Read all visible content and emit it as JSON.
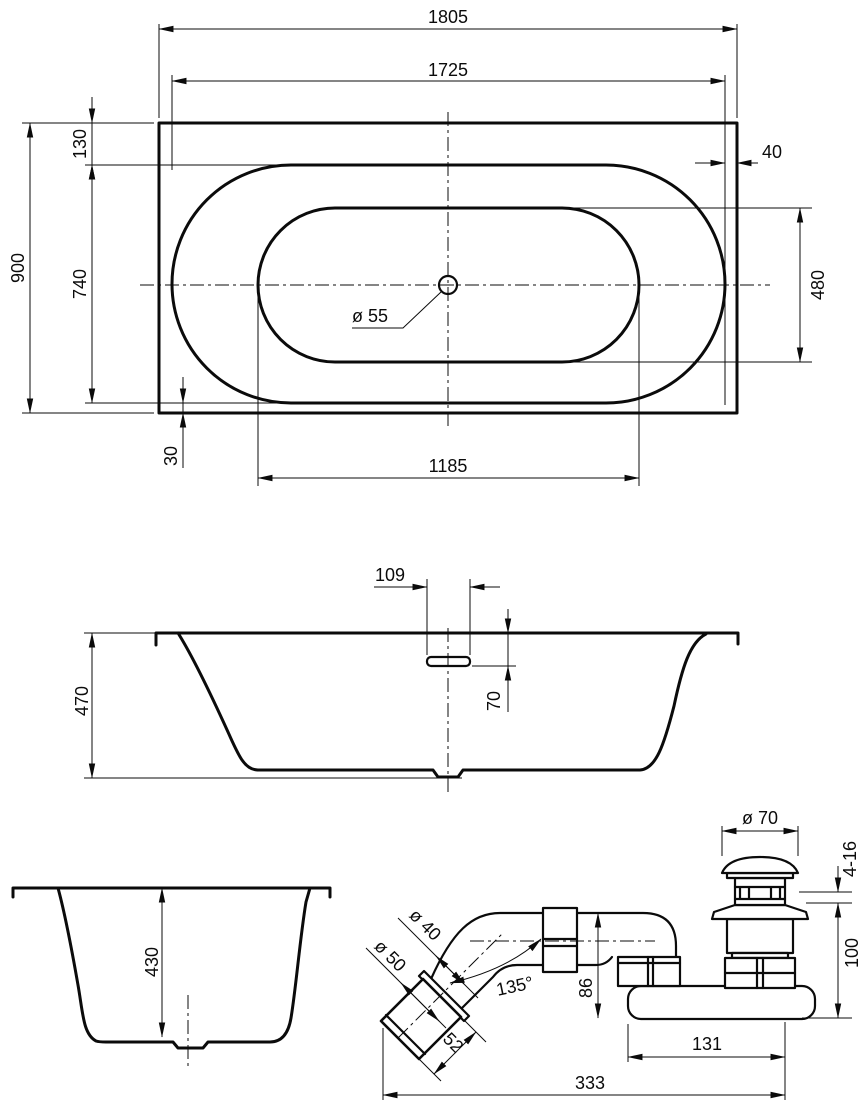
{
  "colors": {
    "line": "#0b0b0b",
    "background": "#ffffff"
  },
  "dimensions": {
    "top_view": {
      "overall_length": "1805",
      "inner_rim_length": "1725",
      "overall_width": "900",
      "rim_top_offset": "130",
      "rim_opening_width": "740",
      "rim_bottom_offset": "30",
      "rim_edge_width": "40",
      "basin_floor_width": "480",
      "basin_floor_length": "1185",
      "drain_hole_diameter": "ø 55"
    },
    "side_view": {
      "overflow_cutout_width": "109",
      "overall_depth": "470",
      "overflow_top_offset": "70"
    },
    "end_view": {
      "inner_depth": "430"
    },
    "drain_detail": {
      "cap_diameter": "ø 70",
      "adjustment_range": "4-16",
      "plug_height": "100",
      "pipe_diameter": "ø 40",
      "socket_diameter": "ø 50",
      "outlet_angle": "135°",
      "trap_height": "86",
      "socket_length": "52",
      "body_length": "131",
      "overall_length": "333"
    }
  }
}
